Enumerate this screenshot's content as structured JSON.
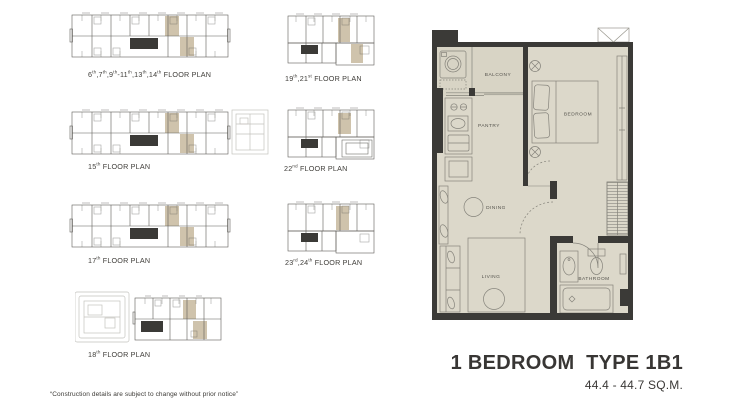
{
  "colors": {
    "floor": "#dcd8ca",
    "balcony_floor": "#d8d4c5",
    "wall": "#3b3a37",
    "highlight_unit": "#cfc3ac",
    "plan_line": "#85837b",
    "thumb_line": "#5f5e59",
    "annex_line": "#c3c2bd"
  },
  "floor_plans": {
    "items": [
      {
        "label": "6th,7th,9th-11th,13th,14th FLOOR PLAN"
      },
      {
        "label": "15th FLOOR PLAN"
      },
      {
        "label": "17th FLOOR PLAN"
      },
      {
        "label": "18th FLOOR PLAN"
      },
      {
        "label": "19th,21st FLOOR PLAN"
      },
      {
        "label": "22nd FLOOR PLAN"
      },
      {
        "label": "23rd,24th FLOOR PLAN"
      }
    ]
  },
  "unit_plan": {
    "rooms": {
      "balcony": "BALCONY",
      "pantry": "PANTRY",
      "bedroom": "BEDROOM",
      "dining": "DINING",
      "living": "LIVING",
      "bathroom": "BATHROOM"
    }
  },
  "unit_info": {
    "title": "1 BEDROOM  TYPE 1B1",
    "area": "44.4 - 44.7 SQ.M."
  },
  "footnote": "“Construction details are subject to change without prior notice”"
}
